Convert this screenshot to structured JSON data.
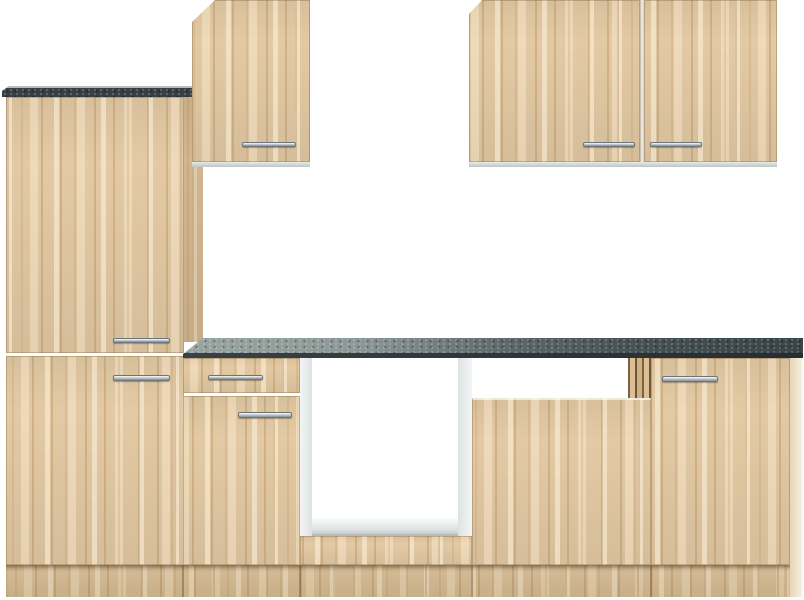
{
  "scene": {
    "type": "product-photo",
    "subject": "kitchenette cabinet set, light beech/oak wood decor with dark speckled worktops and chrome bar handles, on plain white background",
    "background_color": "#ffffff"
  },
  "colors": {
    "wood_front": "#e3caa4",
    "wood_streak": "#a67a4a",
    "wood_shadow_panel": "#c9a97d",
    "worktop_dark": "#373f42",
    "worktop_top_light": "#9aa5a2",
    "carcass_white": "#eceff0",
    "handle_chrome": "#c7cccf"
  },
  "units": {
    "tall_cabinet": {
      "position": "far-left",
      "doors": 2,
      "handles": 2,
      "top": "dark worktop cap"
    },
    "wall_cabinet_single": {
      "position": "upper-middle",
      "doors": 1,
      "handles": 1
    },
    "wall_cabinet_double": {
      "position": "upper-right",
      "doors": 2,
      "handles": 2
    },
    "base_cabinet_drawer_unit": {
      "drawers": 1,
      "doors": 1,
      "handles": 2
    },
    "oven_niche": {
      "state": "open",
      "interior": "white carcass with floor panel"
    },
    "dishwasher_front": {
      "panels": 1,
      "handles": 0,
      "top_slot": "open appliance slot"
    },
    "base_cabinet_right": {
      "doors": 1,
      "handles": 1
    },
    "worktop": {
      "finish": "dark stone speckle",
      "edge": "dark front edge"
    },
    "plinth": {
      "continuous": true,
      "sections": 5
    }
  }
}
